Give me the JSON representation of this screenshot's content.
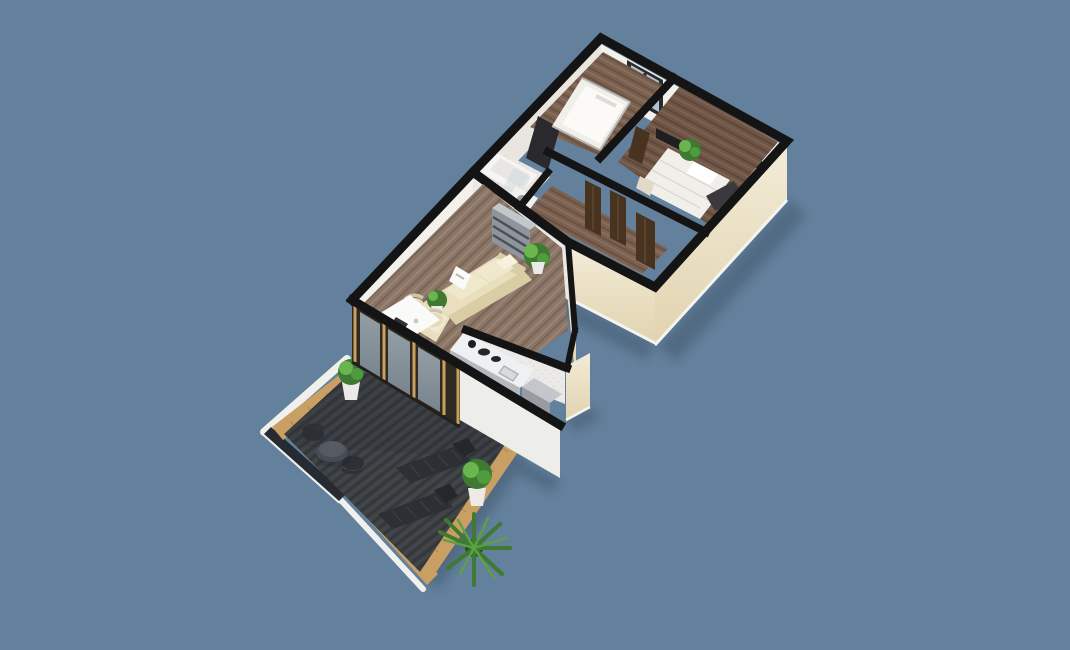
{
  "scene": {
    "kind": "3d-floor-plan-render",
    "view": "elevated-oblique-cutaway",
    "subject": "apartment-with-roof-terrace",
    "background": "#63809c"
  },
  "palette": {
    "bg": "#63809c",
    "wallTop": "#141414",
    "creamLight": "#f2ebd6",
    "creamDark": "#e1d3b0",
    "whiteWall": "#f3f1ec",
    "whiteWallDim": "#e9e6df",
    "tileWall": "#eceae7",
    "baseboard": "#f4f4f1",
    "woodBase": "#7b6150",
    "woodDark": "#6a5243",
    "woodLight": "#8d7160",
    "wood2Base": "#6f5646",
    "wood2Dark": "#5f4739",
    "wood2Light": "#7e6453",
    "livBase": "#8b7667",
    "livDark": "#7a6556",
    "livLight": "#9c8776",
    "bathFloor": "#eae8e5",
    "bathDot": "#d7d5d1",
    "deckBase": "#3e4144",
    "deckDark": "#333639",
    "deckLight": "#46494d",
    "woodBorder": "#c99f63",
    "woodBorderDark": "#a87f47",
    "whiteRim": "#f0f0ed",
    "balustrade": "#262b31",
    "glassTop": "#b7c5d2",
    "glassBottom": "#8fa2b2",
    "framePost": "#c9a05e",
    "frameDark": "#2e2921",
    "windowFrame": "#2b2b2b",
    "windowGlass": "#b3c2d2",
    "sofa": "#e9dfbe",
    "sofaShade": "#d9cda6",
    "cushion": "#f0e8cc",
    "tableWhite": "#fafaf8",
    "chair": "#e4dabb",
    "shelfFront": "#8f959c",
    "shelfTop": "#c2c7cc",
    "shelfLine": "#4a4f55",
    "counterTop": "#eef0f1",
    "counterFront": "#b5b9bc",
    "appliance": "#989ca0",
    "applianceTop": "#c3c7cb",
    "bedWhite": "#f1efe9",
    "bedLine": "#d8d4cd",
    "bunkRail": "#b9b9bb",
    "runner": "#3a3a3e",
    "doorWood": "#47331f",
    "doorWoodLight": "#5d452c",
    "tv": "#1f1f22",
    "wardrobe": "#2a2a2e",
    "plant": "#4f9b3f",
    "plantDark": "#3e7a31",
    "plantLight": "#6ab54e",
    "pot": "#eceae6",
    "darkFurn": "#2c2f33",
    "darkFurnLight": "#3a3e43",
    "bistro": "#474c54",
    "shadow": "#16222e",
    "tub": "#f6f5f2",
    "screen": "#cfd8de",
    "rail": "#23201b"
  },
  "rooms": [
    {
      "name": "bedroom-1",
      "furniture": [
        "bunk-bed",
        "wardrobe",
        "window"
      ]
    },
    {
      "name": "bedroom-2",
      "furniture": [
        "double-bed",
        "bench-runner",
        "nightstand",
        "tv-panel",
        "plant",
        "window"
      ]
    },
    {
      "name": "bathroom",
      "furniture": [
        "bathtub",
        "glass-screen",
        "washing-machine"
      ]
    },
    {
      "name": "hallway",
      "furniture": [
        "entrance-door",
        "interior-doors"
      ]
    },
    {
      "name": "living-dining",
      "furniture": [
        "corner-sofa",
        "side-table",
        "wall-shelf",
        "dining-table",
        "dining-chairs",
        "wall-art",
        "floor-plants"
      ]
    },
    {
      "name": "kitchen",
      "furniture": [
        "counter-with-cooktop-and-sink",
        "tall-cabinet"
      ]
    },
    {
      "name": "terrace",
      "furniture": [
        "sun-lounger",
        "sun-lounger",
        "bistro-table",
        "bistro-chairs",
        "palm-plant",
        "potted-plants",
        "glass-balustrade",
        "wood-planter-border"
      ]
    }
  ]
}
